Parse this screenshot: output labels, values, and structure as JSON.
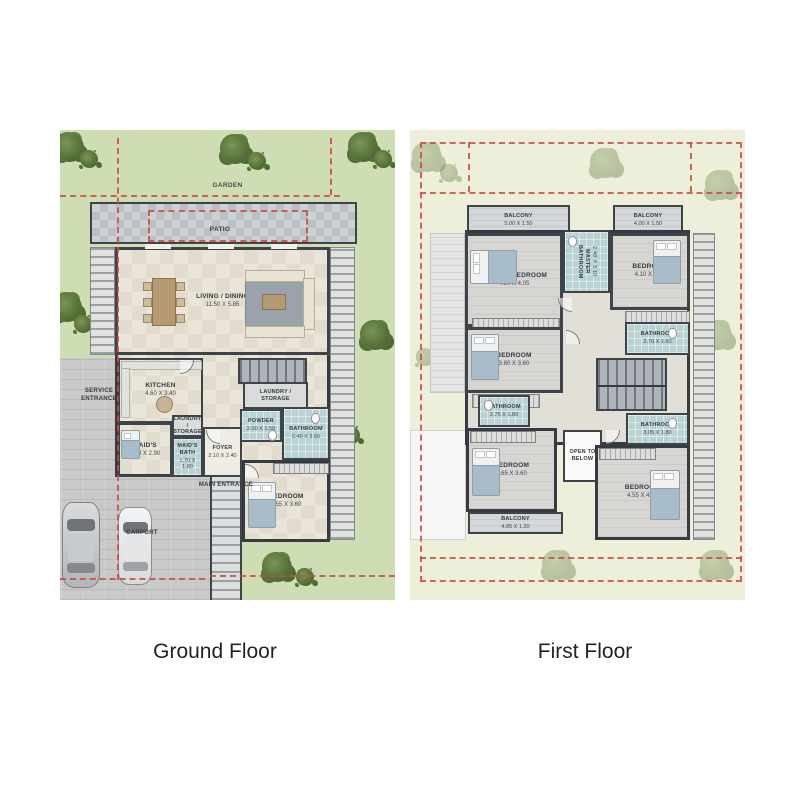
{
  "ground": {
    "title": "Ground Floor",
    "garden_label": "GARDEN",
    "patio_label": "PATIO",
    "service_entrance": "SERVICE ENTRANCE",
    "main_entrance": "MAIN ENTRANCE",
    "carport": "CARPORT",
    "rooms": {
      "living": {
        "name": "LIVING / DINING",
        "dims": "11.50 X 5.85"
      },
      "kitchen": {
        "name": "KITCHEN",
        "dims": "4.60 X 3.40"
      },
      "laundry_storage_a": {
        "name": "LAUNDRY / STORAGE"
      },
      "laundry_storage_b": {
        "name": "LAUNDRY / STORAGE"
      },
      "powder": {
        "name": "POWDER",
        "dims": "2.00 X 1.50"
      },
      "bathroom": {
        "name": "BATHROOM",
        "dims": "2.40 X 2.60"
      },
      "maids": {
        "name": "MAID'S",
        "dims": "2.50 X 2.90"
      },
      "maids_bath": {
        "name": "MAID'S BATH",
        "dims": "1.70 X 1.80"
      },
      "foyer": {
        "name": "FOYER",
        "dims": "2.10 X 2.40"
      },
      "bedroom": {
        "name": "BEDROOM",
        "dims": "4.55 X 3.60"
      }
    }
  },
  "first": {
    "title": "First Floor",
    "rooms": {
      "balcony_left": {
        "name": "BALCONY",
        "dims": "5.00 X 1.50"
      },
      "balcony_right": {
        "name": "BALCONY",
        "dims": "4.00 X 1.50"
      },
      "master_bedroom": {
        "name": "MASTER BEDROOM",
        "dims": "4.90 X 4.05"
      },
      "master_bathroom": {
        "name": "MASTER BATHROOM",
        "dims": "2.40 X 3.10"
      },
      "bedroom_2": {
        "name": "BEDROOM",
        "dims": "4.10 X 3.90"
      },
      "bathroom_2": {
        "name": "BATHROOM",
        "dims": "2.70 X 1.60"
      },
      "bedroom_3": {
        "name": "BEDROOM",
        "dims": "3.80 X 3.60"
      },
      "bathroom_3": {
        "name": "BATHROOM",
        "dims": "2.75 X 1.80"
      },
      "open_to_below": {
        "name": "OPEN TO BELOW"
      },
      "bathroom_4": {
        "name": "BATHROOM",
        "dims": "3.05 X 1.80"
      },
      "bedroom_4": {
        "name": "BEDROOM",
        "dims": "4.65 X 3.60"
      },
      "balcony_bottom": {
        "name": "BALCONY",
        "dims": "4.85 X 1.20"
      },
      "bedroom_5": {
        "name": "BEDROOM",
        "dims": "4.55 X 4.40"
      }
    }
  },
  "colors": {
    "wall": "#3f444a",
    "boundary_red": "#cc4b44",
    "garden_green": "#cfddb5",
    "pale_green": "#edefda",
    "tile_blue": "#b9d3d5",
    "floor_beige": "#eae5d8",
    "floor_gray": "#d7d6d3"
  }
}
